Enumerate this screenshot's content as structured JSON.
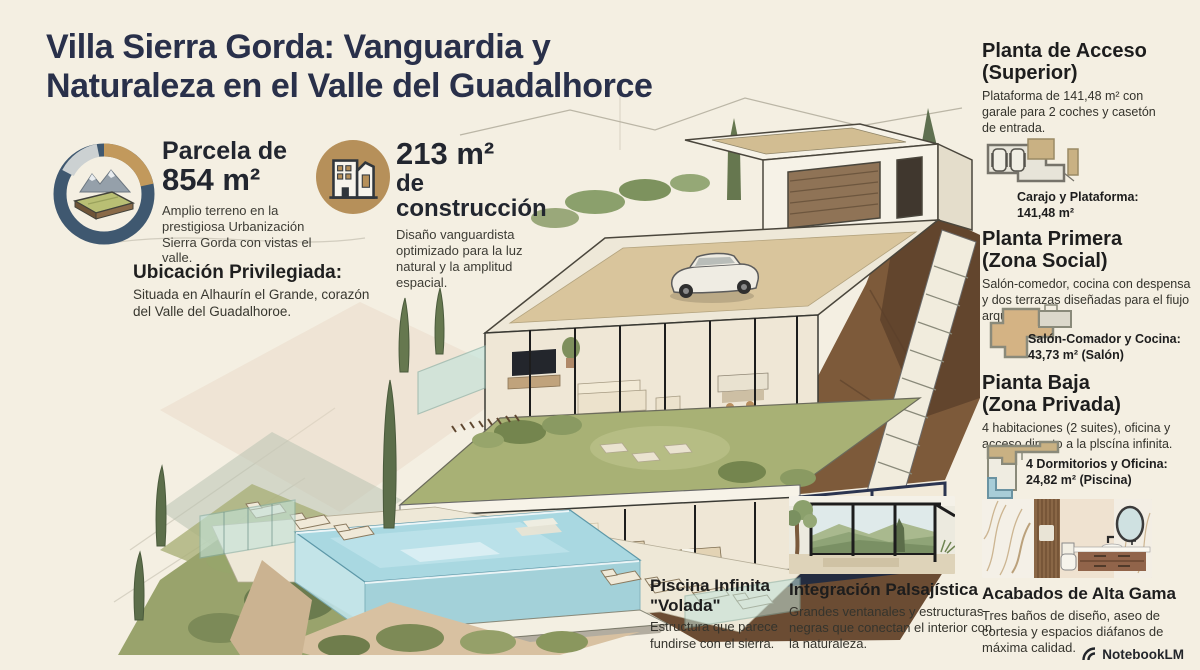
{
  "colors": {
    "background": "#f4efe2",
    "ink": "#29304a",
    "gold": "#c2995c",
    "navy_ring": "#3f5870",
    "pool_blue": "#a9d8e1",
    "hill_brown": "#7d5a3a",
    "olive": "#99a36c"
  },
  "title": {
    "bold": "Villa Sierra Gorda:",
    "rest": " Vanguardia y",
    "line2": "Naturaleza en el Valle del Guadalhorce"
  },
  "stats": {
    "parcela": {
      "heading1": "Parcela de",
      "heading2": "854 m²",
      "desc": "Amplio terreno en la prestigiosa Urbanización Sierra Gorda con vistas el valle."
    },
    "construccion": {
      "heading1": "213 m²",
      "heading2": "de construcción",
      "desc": "Disaño vanguardista optimizado para la luz natural y la amplitud espacial."
    }
  },
  "location": {
    "heading": "Ubicación Privilegiada:",
    "desc": "Situada en Alhaurín el Grande, corazón del Valle del Guadalhoroe."
  },
  "plantas": [
    {
      "h1": "Planta de Acceso",
      "h2": "(Superior)",
      "desc": "Plataforma de 141,48 m² con garale para 2 coches y casetón de entrada.",
      "cap1": "Carajo y Plataforma:",
      "cap2": "141,48 m²"
    },
    {
      "h1": "Planta Primera",
      "h2": "(Zona Social)",
      "desc": "Salón-comedor, cocina con despensa y dos terrazas diseñadas para el fiujo arquitectónico.",
      "cap1": "Salón-Comador y Cocina:",
      "cap2": "43,73 m² (Salón)"
    },
    {
      "h1": "Pianta Baja",
      "h2": "(Zona Privada)",
      "desc": "4 habitaciones (2 suites), oficina y acceso directo a la plscína infinita.",
      "cap1": "4 Dormitorios y Oficina:",
      "cap2": "24,82 m² (Piscina)"
    }
  ],
  "features": {
    "piscina": {
      "h1": "Piscina Infinita",
      "h2": "\"Volada\"",
      "desc": "Estructura que parece fundirse con el sierra."
    },
    "integracion": {
      "h": "Integración Palsajística",
      "desc": "Grandes ventanales y estructuras negras que conectan el interior con la naturaleza."
    },
    "acabados": {
      "h": "Acabados de Alta Gama",
      "desc": "Tres baños de diseño, aseo de cortesia y espacios diáfanos de máxima calidad."
    }
  },
  "footer": {
    "brand": "NotebookLM"
  }
}
